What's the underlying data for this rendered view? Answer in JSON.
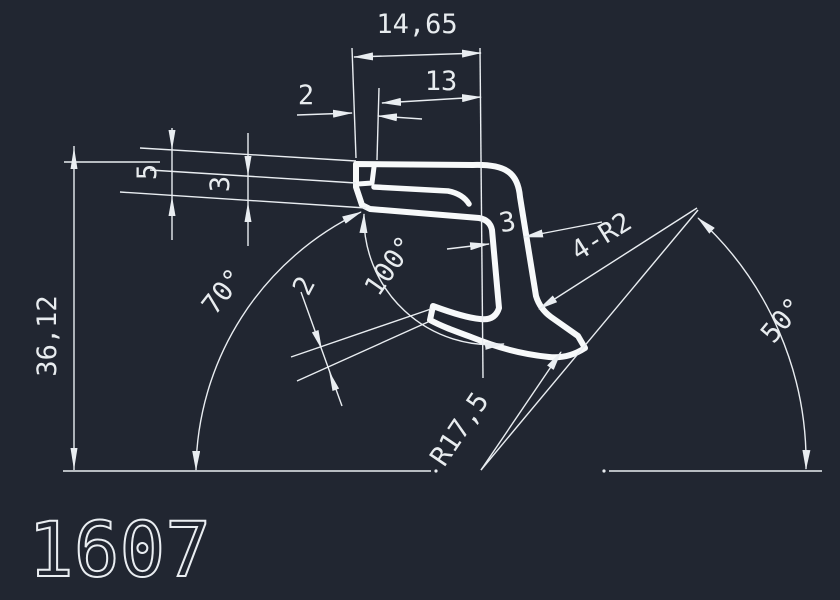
{
  "drawing": {
    "part_number": "1607",
    "colors": {
      "background": "#212631",
      "profile_line": "#F7F9FA",
      "dimension_line": "#E9EDF1",
      "text": "#E8ECEF"
    },
    "dimensions": {
      "top_width": "14,65",
      "top_inner_width": "13",
      "hook_step": "2",
      "lip_outer_height": "5",
      "lip_inner_height": "3",
      "overall_height": "36,12",
      "angle_left": "70°",
      "angle_center": "100°",
      "foot_thickness": "2",
      "stem_thickness": "3",
      "corner_radii": "4-R2",
      "foot_radius": "R17,5",
      "angle_right": "50°"
    }
  }
}
